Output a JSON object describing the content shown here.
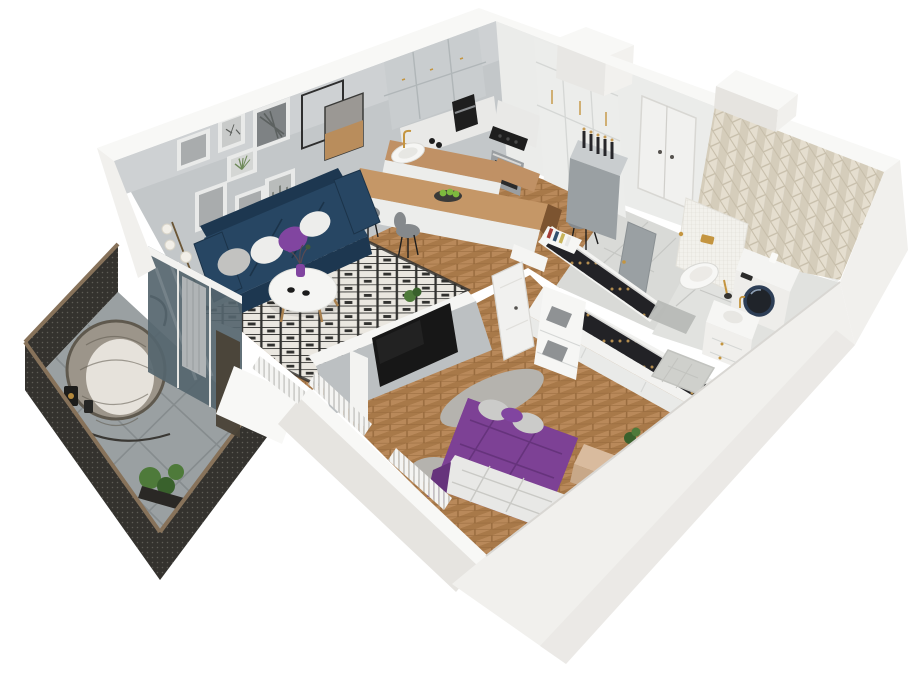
{
  "meta": {
    "title": "3D isometric cutaway render of a one-bedroom apartment floor plan",
    "render_style": "dollhouse perspective, white background, no visible text",
    "canvas": {
      "width": 908,
      "height": 700
    }
  },
  "palette": {
    "bg": "#ffffff",
    "wallTop": "#f8f8f6",
    "wallFace": "#f1f0ed",
    "wallShade": "#e6e4e0",
    "wallDark": "#d9d7d3",
    "innerGray": "#c3c7c9",
    "innerGrayLight": "#ced1d3",
    "neWall": "#ebecea",
    "floorWood1": "#b9895a",
    "floorWood2": "#a87949",
    "floorWoodLine": "#96693c",
    "rugBase": "#eae7e0",
    "rugInk": "#30302e",
    "sofaNavy": "#274663",
    "sofaDark": "#1d3750",
    "pillowWhite": "#ededeb",
    "pillowGray": "#c2c2c0",
    "accentPurple": "#8145a0",
    "bedPurple": "#7d4195",
    "bedPurpleDark": "#66337c",
    "sheetWhite": "#e8e8e6",
    "pillowBedGray": "#cbcbc9",
    "fluffGray": "#b5b3ae",
    "tableWhite": "#f5f5f3",
    "woodLeg": "#a9814f",
    "islandWood": "#c59767",
    "islandWoodDark": "#7c5430",
    "cabinetWhite": "#ecedeb",
    "cabinetLine": "#d5d7d5",
    "grayCab": "#c9cdcf",
    "grayCabLine": "#b0b6b8",
    "grayCabBody": "#9aa0a3",
    "counterWood": "#c09165",
    "marble": "#e9e9e7",
    "steel": "#9a9ea1",
    "black": "#1e1e1e",
    "gold": "#c49540",
    "chairGray": "#85898c",
    "appleGreen": "#7db93e",
    "hallTile": "#d9dad7",
    "hallTileLine": "#c6c7c4",
    "bathTile": "#e1e2df",
    "showerTile": "#cfd0cc",
    "accentTile1": "#e5decf",
    "accentTile2": "#d5cdbb",
    "accentLine": "#c6bda9",
    "mosaic": "#f2f1ec",
    "mosaicLine": "#dedbd3",
    "toiletWhite": "#f7f7f5",
    "washerNavy": "#2d3e56",
    "balconyTile": "#9aa0a2",
    "balconyLine": "#868c8e",
    "railDark": "#34322e",
    "railDot": "#6e6c64",
    "railCap": "#87725a",
    "rattan": "#9c958a",
    "rattanDark": "#5f594e",
    "cushion": "#e6e2db",
    "glass": "#55656e",
    "bronzePanel": "#4a4237",
    "curtain": "#b0b4b6",
    "tvBlack": "#171717",
    "tvWallGray": "#bcc0c2",
    "doorWhite": "#f1f1ef",
    "doorGray": "#9aa0a3",
    "clothesDark": "#222226",
    "hanger": "#c59a55",
    "greenPlant": "#4e7a3a",
    "greenPlantDark": "#39612c",
    "boxGray": "#8f9294",
    "photoGray": "#a9acad",
    "photoDark": "#7e8284",
    "photoTan": "#b98d5c"
  },
  "scene": {
    "type": "isometric-apartment-cutaway",
    "rooms": [
      {
        "id": "living-room",
        "features": [
          "gallery-wall-seven-framed-prints",
          "two-overlapping-square-wire-frames",
          "navy-three-seat-sofa",
          "throw-pillows-white-gray-purple",
          "round-white-coffee-table",
          "purple-vase-with-flowers",
          "two-espresso-cups",
          "black-white-diamond-pattern-rug",
          "brass-floor-lamp-three-globes",
          "herringbone-oak-floor",
          "sliding-glass-balcony-door",
          "gray-curtain"
        ]
      },
      {
        "id": "kitchen",
        "features": [
          "gray-upper-cabinets",
          "white-tall-cabinets",
          "built-in-oven",
          "black-gas-hob",
          "black-coffee-machine",
          "marble-backsplash",
          "wood-countertop",
          "white-sink-with-gold-faucet",
          "wood-peninsula-island",
          "bowl-of-green-apples",
          "three-gray-bar-chairs",
          "ventilation-shaft"
        ]
      },
      {
        "id": "hallway",
        "features": [
          "entrance-double-door",
          "gray-sideboard-with-rack-items",
          "colorful-books-shelf",
          "gray-ceramic-tile-floor",
          "gray-bathroom-door"
        ]
      },
      {
        "id": "bathroom",
        "features": [
          "beige-herringbone-accent-wall",
          "white-mosaic-half-wall",
          "gold-flush-plate",
          "wall-hung-toilet",
          "gold-toilet-brush",
          "washing-machine-dark-door",
          "white-vanity-with-gold-handles",
          "tiled-shower-tray",
          "gray-bath-mat",
          "light-tile-floor"
        ]
      },
      {
        "id": "bedroom",
        "features": [
          "double-bed-purple-bedding",
          "white-duvet-at-foot",
          "gray-pillows",
          "gray-fluffy-rug",
          "wood-bedside-bench",
          "potted-plant",
          "gray-tv-wall",
          "wall-mounted-tv",
          "white-interior-door",
          "white-radiator-slats",
          "walk-in-wardrobe-two-rows-dark-clothes",
          "gray-storage-boxes",
          "white-sliding-fronts",
          "herringbone-oak-floor"
        ]
      },
      {
        "id": "balcony",
        "features": [
          "dark-perforated-metal-railing",
          "wood-handrail-cap",
          "gray-tile-floor",
          "rattan-hanging-egg-chair",
          "white-seat-cushion",
          "black-lantern",
          "potted-plants"
        ]
      }
    ]
  }
}
